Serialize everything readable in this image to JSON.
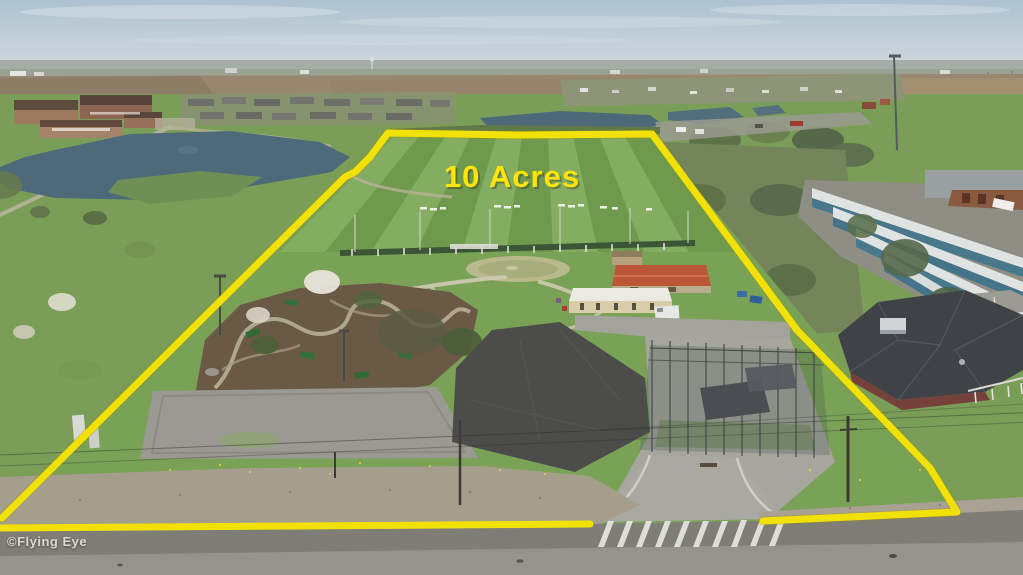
{
  "meta": {
    "type": "aerial-drone-photograph",
    "subject": "10 acre recreation property outlined in yellow (driving range, mini golf, batting cages)",
    "width_px": 1023,
    "height_px": 575
  },
  "annotation": {
    "acreage_label": "10 Acres",
    "label_color": "#ffe408",
    "boundary_color": "#f2e107"
  },
  "watermark": {
    "text": "©Flying Eye",
    "color": "#e9e9e6"
  },
  "palette": {
    "sky_top": "#aec2d1",
    "sky_bottom": "#ccd7dc",
    "farmland_brown": "#98876e",
    "grass_green": "#7a9e57",
    "range_stripe_light": "#84ad61",
    "range_stripe_dark": "#6f9a4d",
    "pond_water": "#4e6a7a",
    "asphalt_new": "#4c4c4a",
    "asphalt_old": "#9a9a92",
    "road_gray": "#7e7d76",
    "storage_roof_white": "#dfe3e1",
    "storage_door_teal": "#47788c",
    "barn_red_roof": "#bb5636",
    "house_dark_roof": "#3f4347",
    "mulch_brown": "#6a5a45"
  }
}
